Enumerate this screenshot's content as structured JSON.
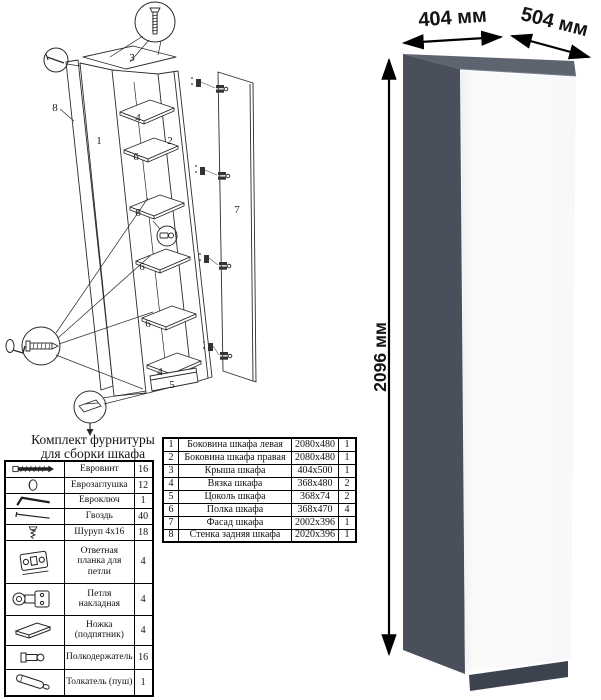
{
  "hardware_kit": {
    "title": {
      "line1": "Комплект фурнитуры",
      "line2": "для сборки шкафа"
    },
    "rows": [
      {
        "icon": "confirmat-screw",
        "name": "Евровинт",
        "qty": "16"
      },
      {
        "icon": "euro-cap",
        "name": "Еврозаглушка",
        "qty": "12"
      },
      {
        "icon": "hex-key",
        "name": "Евроключ",
        "qty": "1"
      },
      {
        "icon": "nail",
        "name": "Гвоздь",
        "qty": "40"
      },
      {
        "icon": "wood-screw",
        "name": "Шуруп 4x16",
        "qty": "18"
      },
      {
        "icon": "hinge-mounting-plate",
        "name": "Ответная планка для петли",
        "qty": "4"
      },
      {
        "icon": "overlay-hinge",
        "name": "Петля накладная",
        "qty": "4"
      },
      {
        "icon": "foot-glide",
        "name": "Ножка (подпятник)",
        "qty": "4"
      },
      {
        "icon": "shelf-support",
        "name": "Полкодержатель",
        "qty": "16"
      },
      {
        "icon": "push-opener",
        "name": "Толкатель (пуш)",
        "qty": "1"
      }
    ]
  },
  "parts_table": {
    "rows": [
      {
        "num": "1",
        "name": "Боковина шкафа левая",
        "size": "2080x480",
        "qty": "1"
      },
      {
        "num": "2",
        "name": "Боковина шкафа правая",
        "size": "2080x480",
        "qty": "1"
      },
      {
        "num": "3",
        "name": "Крыша шкафа",
        "size": "404x500",
        "qty": "1"
      },
      {
        "num": "4",
        "name": "Вязка шкафа",
        "size": "368x480",
        "qty": "2"
      },
      {
        "num": "5",
        "name": "Цоколь шкафа",
        "size": "368x74",
        "qty": "2"
      },
      {
        "num": "6",
        "name": "Полка шкафа",
        "size": "368x470",
        "qty": "4"
      },
      {
        "num": "7",
        "name": "Фасад шкафа",
        "size": "2002x396",
        "qty": "1"
      },
      {
        "num": "8",
        "name": "Стенка задняя шкафа",
        "size": "2020x396",
        "qty": "1"
      }
    ]
  },
  "exploded_view": {
    "labels": {
      "left_side": "1",
      "right_side": "2",
      "top": "3",
      "tie": "4",
      "plinth": "5",
      "shelf": "6",
      "facade": "7",
      "back_panel": "8"
    }
  },
  "render": {
    "dimensions": {
      "width": "404 мм",
      "depth": "504 мм",
      "height": "2096 мм"
    },
    "colors": {
      "top": "#5d6470",
      "side": "#49505b",
      "door": "#fbfbfc",
      "plinth": "#3d434e"
    }
  }
}
